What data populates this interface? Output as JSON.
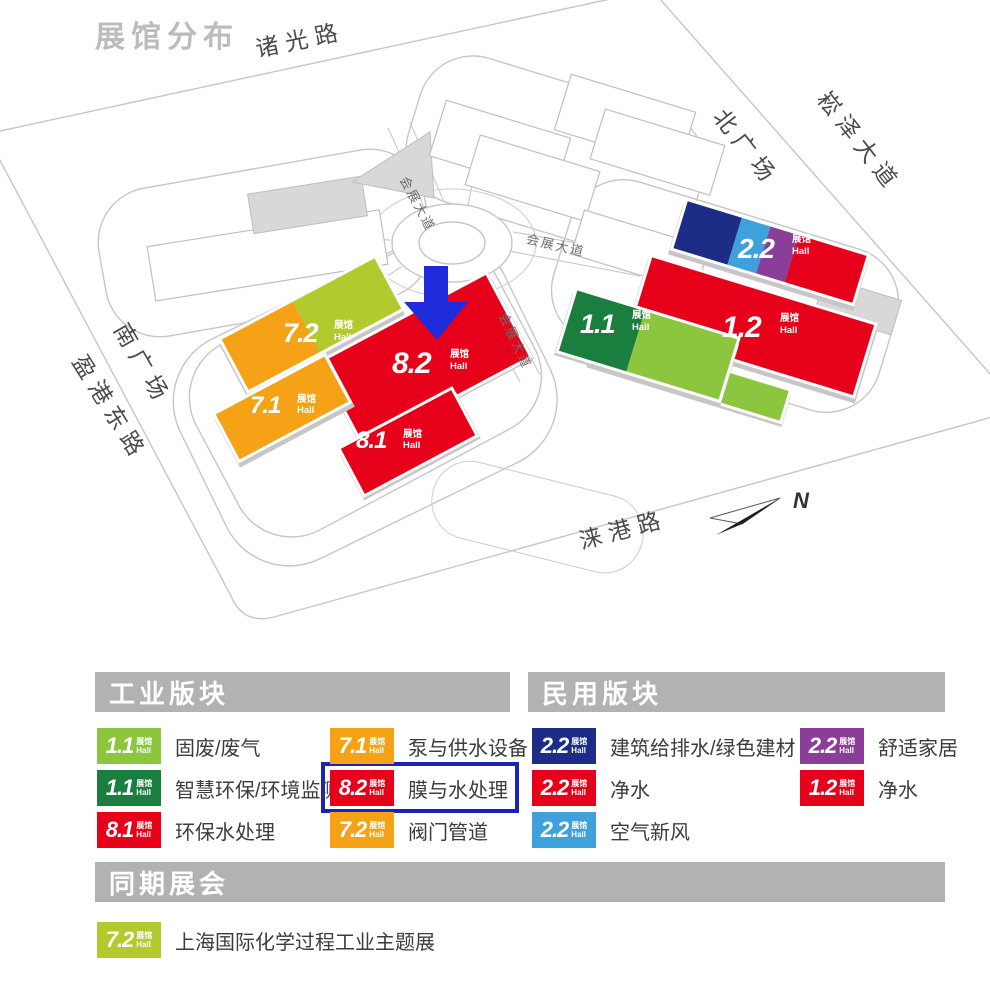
{
  "title": "展馆分布",
  "colors": {
    "red": "#e60019",
    "orange": "#f5a216",
    "yellow_green": "#b2ca2d",
    "light_green": "#8cc63f",
    "dark_green": "#1a7e3f",
    "navy": "#1d2d87",
    "sky": "#3fa1dc",
    "purple": "#8a3e98",
    "arrow_blue": "#1e2cdb",
    "highlight": "#1b24b5",
    "header_gray": "#b2b2b2",
    "title_gray": "#bcbcbc"
  },
  "map": {
    "roads": {
      "zhuguang": "诸光路",
      "songze": "崧泽大道",
      "north_plaza": "北广场",
      "south_plaza": "南广场",
      "yinggang": "盈港东路",
      "laigang": "涞港路",
      "huizhan_nw": "会展大道",
      "huizhan_e": "会展大道",
      "huizhan_se": "会展大道"
    },
    "compass_n": "N",
    "hall_sub": {
      "zh": "展馆",
      "en": "Hall"
    },
    "halls": {
      "h72": {
        "code": "7.2"
      },
      "h71": {
        "code": "7.1"
      },
      "h82": {
        "code": "8.2"
      },
      "h81": {
        "code": "8.1"
      },
      "h11": {
        "code": "1.1"
      },
      "h12": {
        "code": "1.2"
      },
      "h22": {
        "code": "2.2"
      }
    }
  },
  "legend": {
    "badge_sub": {
      "zh": "展馆",
      "en": "Hall"
    },
    "industrial": {
      "header": "工业版块",
      "items": [
        {
          "code": "1.1",
          "color": "light_green",
          "label": "固废/废气"
        },
        {
          "code": "1.1",
          "color": "dark_green",
          "label": "智慧环保/环境监测"
        },
        {
          "code": "8.1",
          "color": "red",
          "label": "环保水处理"
        },
        {
          "code": "7.1",
          "color": "orange",
          "label": "泵与供水设备"
        },
        {
          "code": "8.2",
          "color": "red",
          "label": "膜与水处理",
          "highlighted": true
        },
        {
          "code": "7.2",
          "color": "orange",
          "label": "阀门管道"
        }
      ]
    },
    "civil": {
      "header": "民用版块",
      "items": [
        {
          "code": "2.2",
          "color": "navy",
          "label": "建筑给排水/绿色建材"
        },
        {
          "code": "2.2",
          "color": "red",
          "label": "净水"
        },
        {
          "code": "2.2",
          "color": "sky",
          "label": "空气新风"
        },
        {
          "code": "2.2",
          "color": "purple",
          "label": "舒适家居"
        },
        {
          "code": "1.2",
          "color": "red",
          "label": "净水"
        }
      ]
    },
    "concurrent": {
      "header": "同期展会",
      "items": [
        {
          "code": "7.2",
          "color": "yellow_green",
          "label": "上海国际化学过程工业主题展"
        }
      ]
    }
  }
}
